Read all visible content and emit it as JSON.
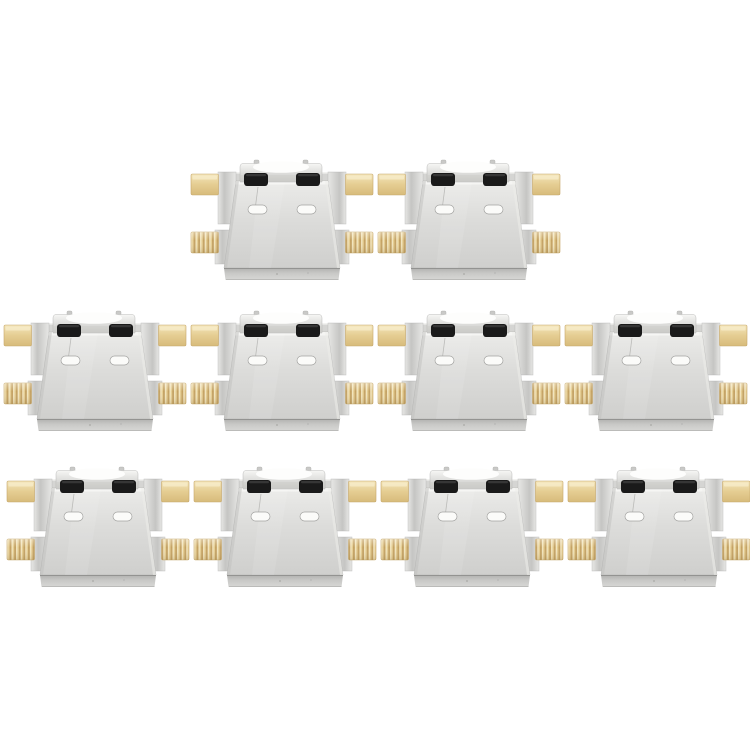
{
  "meta": {
    "description": "Product photo: 10 PCS micro-USB charging port connector modules arranged in three rows on a white background",
    "item_count": 10,
    "background": "#ffffff"
  },
  "palette": {
    "metal-plate-top": "#ebebe9",
    "metal-plate-mid": "#dcdcda",
    "metal-plate-bottom": "#cfcfcd",
    "metal-shoulder": "#d5d5d3",
    "metal-shoulder-highlight": "#f2f2f0",
    "metal-flange-dark": "#c5c5c3",
    "metal-flange-light": "#e7e7e5",
    "metal-bevel-dark": "#b1b1af",
    "metal-bevel-light": "#d7d7d5",
    "metal-outline": "#adadab",
    "port-block-light": "#f6f6f4",
    "port-block-dark": "#c6c6c4",
    "port-tongue": "#fdfdfc",
    "slot-black": "#1a1a1a",
    "slot-white": "#fbfbf9",
    "gold-light": "#f4e6bb",
    "gold-mid": "#e5cd92",
    "gold-dark": "#d7bb7b",
    "gold-ridge-dark": "#c4a263",
    "gold-ridge-light": "#f3e6c0",
    "gold-outline": "#c6a76a",
    "pin-gray": "#c9c9c7"
  },
  "connectors": {
    "symbol_width": 186,
    "symbol_height": 122,
    "rows": [
      {
        "name": "top",
        "count": 2,
        "positions": [
          {
            "x": 189,
            "y": 160
          },
          {
            "x": 376,
            "y": 160
          }
        ]
      },
      {
        "name": "middle",
        "count": 4,
        "positions": [
          {
            "x": 2,
            "y": 311
          },
          {
            "x": 189,
            "y": 311
          },
          {
            "x": 376,
            "y": 311
          },
          {
            "x": 563,
            "y": 311
          }
        ]
      },
      {
        "name": "bottom",
        "count": 4,
        "positions": [
          {
            "x": 5,
            "y": 467
          },
          {
            "x": 192,
            "y": 467
          },
          {
            "x": 379,
            "y": 467
          },
          {
            "x": 566,
            "y": 467
          }
        ]
      }
    ]
  }
}
